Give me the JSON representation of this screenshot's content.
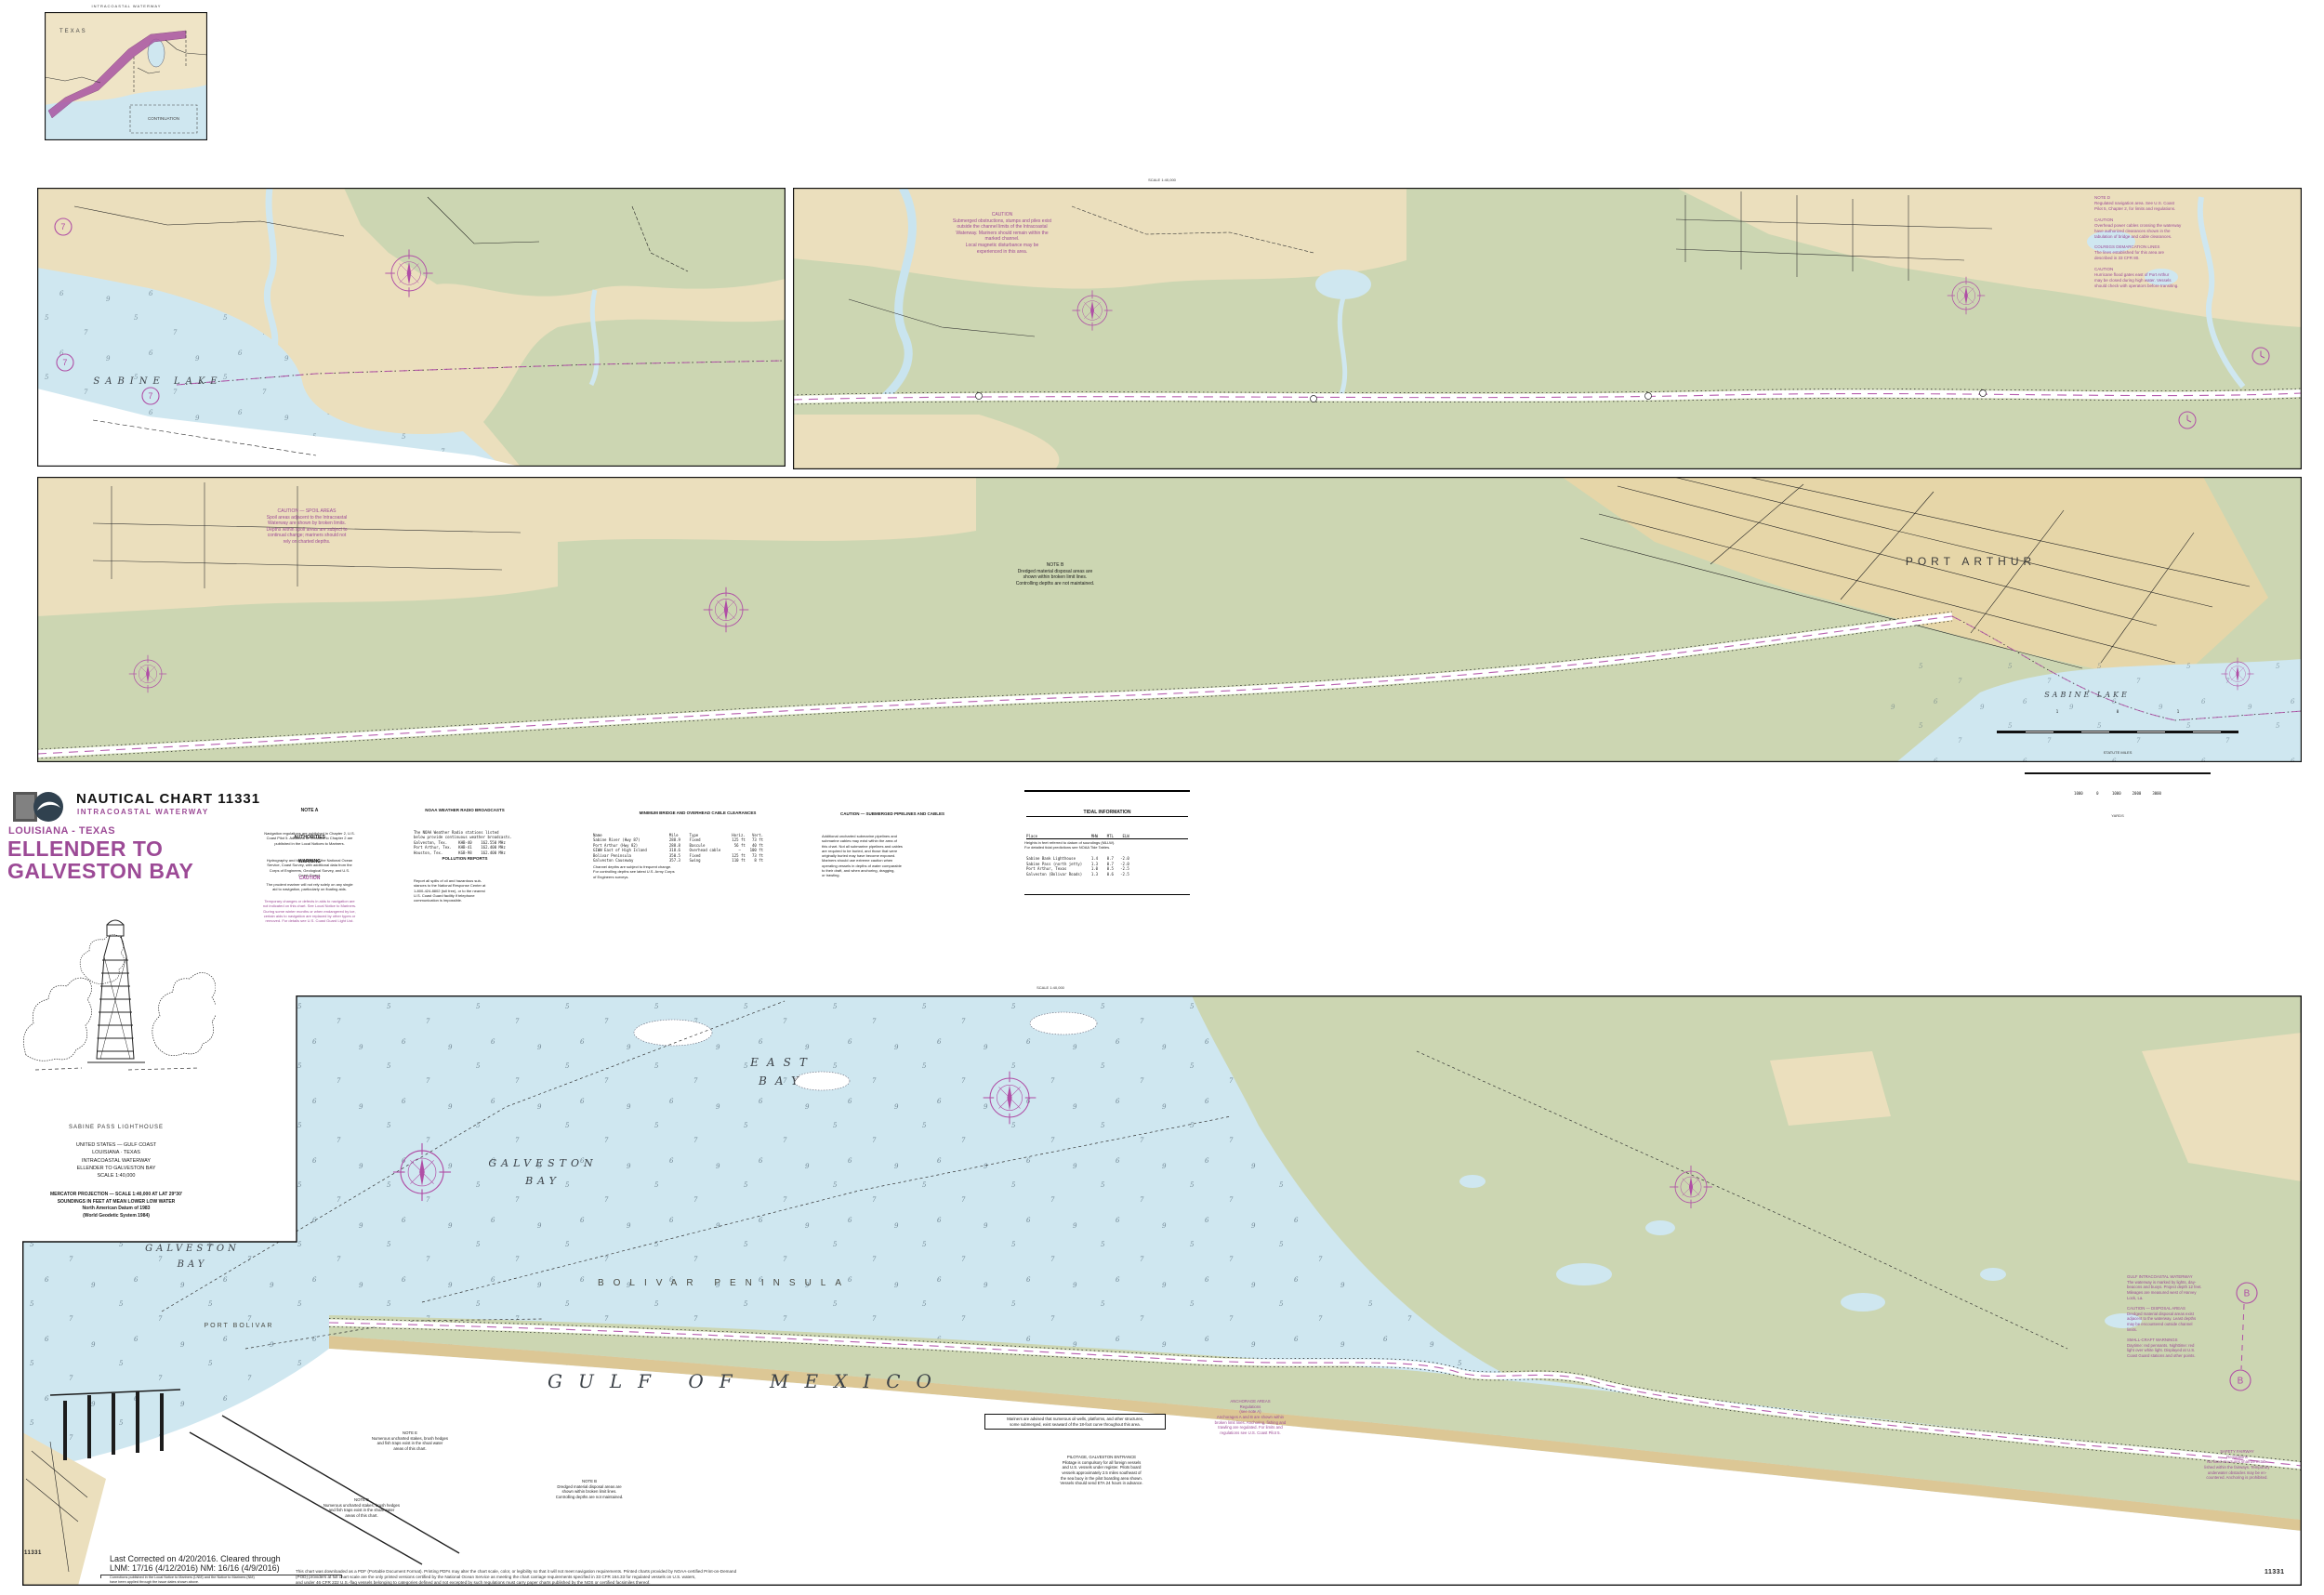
{
  "chart": {
    "number": "11331",
    "title": "NAUTICAL CHART 11331",
    "subtitle": "INTRACOASTAL WATERWAY",
    "region": "LOUISIANA - TEXAS",
    "name1": "ELLENDER TO",
    "name2": "GALVESTON BAY"
  },
  "inset": {
    "title": "INTRACOASTAL WATERWAY",
    "texas": "TEXAS",
    "continuation": "CONTINUATION"
  },
  "symbols": {
    "seven": "7",
    "b": "B"
  },
  "top_labels": {
    "scale": "SCALE 1:40,000"
  },
  "water_labels": {
    "sabine_lake": "SABINE LAKE",
    "sabine_lake2": "SABINE LAKE",
    "port_arthur": "PORT ARTHUR",
    "east_bay": "EAST\nBAY",
    "galveston_bay_e": "GALVESTON\nBAY",
    "galveston_bay_w": "GALVESTON\nBAY",
    "bolivar": "BOLIVAR PENINSULA",
    "port_bolivar": "PORT BOLIVAR",
    "gulf": "GULF OF MEXICO"
  },
  "header_notes": {
    "note_a_title": "NOTE A",
    "note_a_body": "Navigation regulations are published in Chapter 2, U.S.\nCoast Pilot 5. Additions or revisions to Chapter 2 are\npublished in the Local Notices to Mariners.",
    "auth_title": "AUTHORITIES",
    "auth_body": "Hydrography and topography by the National Ocean\nService, Coast Survey, with additional data from the\nCorps of Engineers, Geological Survey, and U.S.\nCoast Guard.",
    "warn_title": "WARNING",
    "warn_body": "The prudent mariner will not rely solely on any single\naid to navigation, particularly on floating aids.",
    "caution_title": "CAUTION",
    "caution_body": "Temporary changes or defects in aids to navigation are\nnot indicated on this chart. See Local Notice to Mariners.\nDuring some winter months or when endangered by ice,\ncertain aids to navigation are replaced by other types or\nremoved. For details see U.S. Coast Guard Light List.",
    "wx_title": "NOAA WEATHER RADIO BROADCASTS",
    "wx_body": "The NOAA Weather Radio stations listed\nbelow provide continuous weather broadcasts.\nGalveston, Tex.     KHB-40    162.550 MHz\nPort Arthur, Tex.   KHB-41    162.400 MHz\nHouston, Tex.       KGB-98    162.400 MHz",
    "poll_title": "POLLUTION REPORTS",
    "poll_body": "Report all spills of oil and hazardous sub-\nstances to the National Response Center at\n1-800-424-8802 (toll free), or to the nearest\nU.S. Coast Guard facility if telephone\ncommunication is impossible.",
    "bridge_title": "MINIMUM BRIDGE AND OVERHEAD CABLE CLEARANCES",
    "bridge_body": "Name                              Mile     Type               Horiz.   Vert.\nSabine River (Hwy 87)             288.9    Fixed              125 ft   73 ft\nPort Arthur (Hwy 82)              288.8    Bascule             56 ft   40 ft\nGIWW East of High Island          318.6    Overhead cable        —    100 ft\nBolivar Peninsula                 350.5    Fixed              125 ft   73 ft\nGalveston Causeway                357.3    Swing              110 ft    8 ft",
    "depths_note": "Channel depths are subject to frequent change.\nFor controlling depths see latest U.S. Army Corps\nof Engineers surveys.",
    "pipe_title": "CAUTION — SUBMERGED PIPELINES AND CABLES",
    "pipe_body": "Additional uncharted submarine pipelines and\nsubmarine cables may exist within the area of\nthis chart. Not all submarine pipelines and cables\nare required to be buried, and those that were\noriginally buried may have become exposed.\nMariners should use extreme caution when\noperating vessels in depths of water comparable\nto their draft, and when anchoring, dragging,\nor trawling."
  },
  "tide": {
    "title": "TIDAL INFORMATION",
    "head": "Place                        MHW    MTL    ELW",
    "rows": "Sabine Bank Lighthouse       1.4    0.7   -2.0\nSabine Pass (north jetty)    1.3    0.7   -2.0\nPort Arthur, Texas           1.0    0.5   -2.5\nGalveston (Bolivar Roads)    1.3    0.6   -2.5",
    "note": "Heights in feet referred to datum of soundings (MLLW).\nFor detailed tidal predictions see NOAA Tide Tables."
  },
  "map_notes": {
    "s1_caution": "CAUTION\nSubmerged obstructions, stumps and piles exist\noutside the channel limits of the Intracoastal\nWaterway. Mariners should remain within the\nmarked channel.\nLocal magnetic disturbance may be\nexperienced in this area.",
    "s1_side": "NOTE D\nRegulated navigation area. See U.S. Coast\nPilot 5, Chapter 2, for limits and regulations.\n\nCAUTION\nOverhead power cables crossing the waterway\nhave authorized clearances shown in the\ntabulation of bridge and cable clearances.\n\nCOLREGS DEMARCATION LINES\nThe lines established for this area are\ndescribed in 33 CFR 80.\n\nCAUTION\nHurricane flood gates east of Port Arthur\nmay be closed during high water. Vessels\nshould check with operators before transiting.",
    "s2_caution": "CAUTION — SPOIL AREAS\nSpoil areas adjacent to the Intracoastal\nWaterway are shown by broken limits.\nDepths within spoil areas are subject to\ncontinual change; mariners should not\nrely on charted depths.",
    "s2_note_b": "NOTE B\nDredged material disposal areas are\nshown within broken limit lines.\nControlling depths are not maintained.",
    "gulf_box": "Mariners are advised that numerous oil wells, platforms, and other structures,\nsome submerged, exist seaward of the 18-foot curve throughout this area.",
    "gulf_e": "NOTE E\nNumerous uncharted stakes, brush hedges\nand fish traps exist in the shoal water\nareas of this chart.",
    "gulf_pilot": "PILOTAGE, GALVESTON ENTRANCE\nPilotage is compulsory for all foreign vessels\nand U.S. vessels under register. Pilots board\nvessels approximately 2.5 miles southeast of\nthe sea buoy in the pilot boarding area shown.\nVessels should send ETA 24 hours in advance.",
    "gulf_anch": "ANCHORAGE AREAS\nRegulations\n(see note A)\nAnchorages A and B are shown within\nbroken limit lines. Anchoring, fishing and\ntrawling are regulated. For limits and\nregulations see U.S. Coast Pilot 5.",
    "gulf_fairway": "SAFETY FAIRWAY\nRegulations\nNo fixed structures shall be estab-\nlished within the fairways. Temporary\nunderwater obstacles may be en-\ncountered. Anchoring is prohibited.",
    "bp_right": "GULF INTRACOASTAL WATERWAY\nThe waterway is marked by lights, day-\nbeacons and buoys. Project depth 12 feet.\nMileages are measured west of Harvey\nLock, La.\n\nCAUTION — DISPOSAL AREAS\nDredged material disposal areas exist\nadjacent to the waterway. Least depths\nmay be encountered outside channel\nlimits.\n\nSMALL-CRAFT WARNINGS\nDaytime: red pennants. Nighttime: red\nlight over white light. Displayed at U.S.\nCoast Guard stations and other points."
  },
  "proj": {
    "caption": "SABINE PASS LIGHTHOUSE",
    "block1": "UNITED STATES — GULF COAST\nLOUISIANA · TEXAS\nINTRACOASTAL WATERWAY\nELLENDER TO GALVESTON BAY\nSCALE 1:40,000",
    "block2": "MERCATOR PROJECTION — SCALE 1:40,000 AT LAT 29°30'\nSOUNDINGS IN FEET AT MEAN LOWER LOW WATER\nNorth American Datum of 1983\n(World Geodetic System 1984)"
  },
  "scalebar": {
    "miles_ticks": "1                          0                          1",
    "miles_label": "STATUTE MILES",
    "yards_ticks": "1000      0      1000     2000     3000",
    "yards_label": "YARDS"
  },
  "margin": {
    "chart_no_left": "11331",
    "chart_no_right": "11331",
    "corrected1": "Last Corrected on 4/20/2016.  Cleared through",
    "corrected2": "LNM: 17/16 (4/12/2016)   NM: 16/16 (4/9/2016)",
    "fine": "Corrections published in the Local Notice to Mariners (LNM) and the Notice to Mariners (NM)\nhave been applied through the issue dates shown above.",
    "disclaimer": "This chart was downloaded as a PDF (Portable Document Format). Printing PDFs may alter the chart scale, color, or legibility so that it will not meet navigation requirements. Printed charts provided by NOAA-certified Print-on-Demand\n(POD) providers at full chart scale are the only printed versions certified by the National Ocean Service as meeting the chart carriage requirements specified in 33 CFR 164.33 for regulated vessels on U.S. waters,\nand under 46 CFR 222 U.S.-flag vessels belonging to categories defined and not excepted by such regulations must carry paper charts published by the NOS or certified facsimiles thereof."
  }
}
